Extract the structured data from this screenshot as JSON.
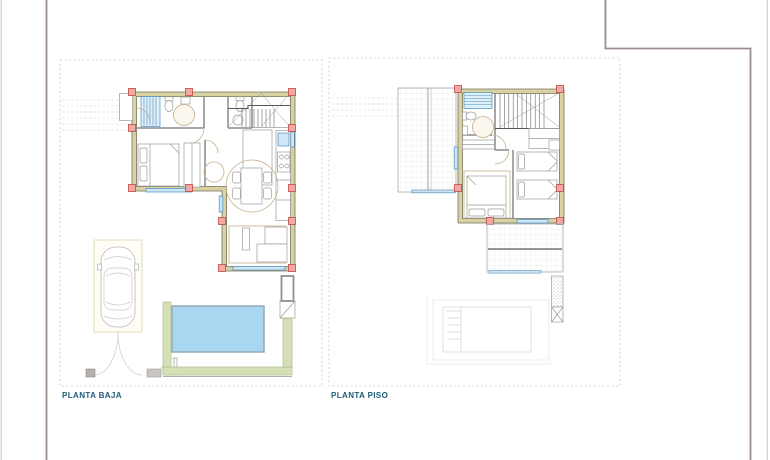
{
  "plans": [
    {
      "id": "planta-baja",
      "label": "PLANTA BAJA"
    },
    {
      "id": "planta-piso",
      "label": "PLANTA PISO"
    }
  ],
  "colors": {
    "wall_fill": "#d8d2a2",
    "wall_line": "#74745c",
    "column_fill": "#f2a8a4",
    "column_line": "#c04840",
    "window_fill": "#cfe6f5",
    "window_line": "#4a8fc0",
    "shower_fill": "#dff0f9",
    "pool_fill": "#a9d6f0",
    "pool_line": "#8fa6b4",
    "terrace_fill": "#d4e1b6",
    "terrace_line": "#a4b488",
    "furniture_line": "#c4b088",
    "fixture_line": "#9a9a9a",
    "stair_line": "#6a6a6a",
    "grid_border": "#b4b4b4",
    "plot_dash": "#c8c8c8",
    "ghost": "#d4d4d4",
    "frame_line": "#9c8c8c",
    "label_text": "#1f5b76"
  }
}
